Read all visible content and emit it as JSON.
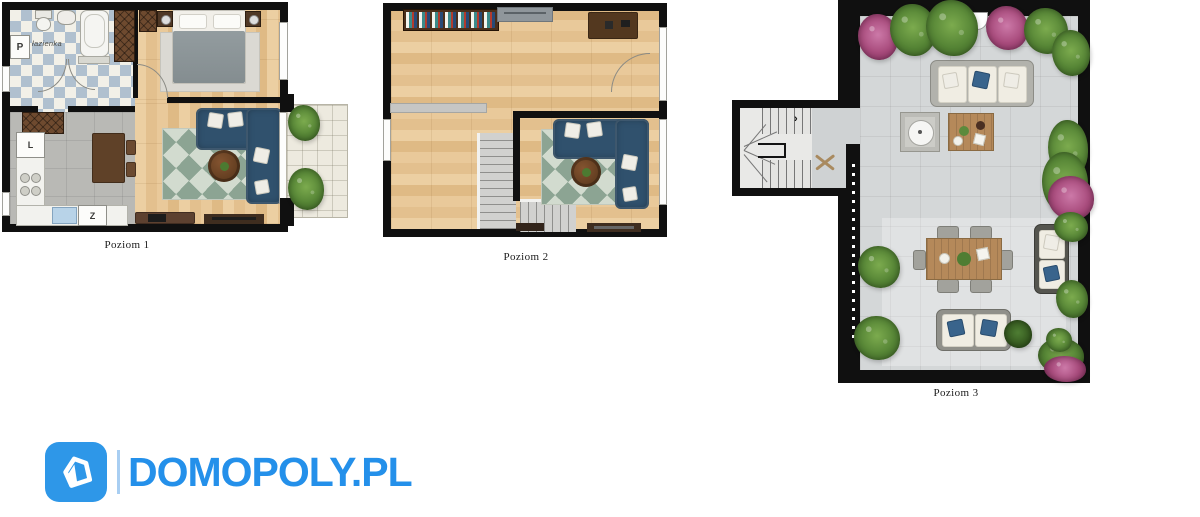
{
  "document": {
    "type": "apartment-floor-plan-sheet",
    "background": "#ffffff"
  },
  "plans": [
    {
      "label": "Poziom 1",
      "labels": {
        "bathroom": "łazienka",
        "pantry": "P",
        "appliance_l": "L",
        "appliance_z": "Z"
      },
      "rooms": [
        "bathroom",
        "hallway",
        "bedroom",
        "kitchen",
        "living-room",
        "balcony"
      ]
    },
    {
      "label": "Poziom 2",
      "rooms": [
        "open-space",
        "living-room",
        "staircase",
        "desk-area"
      ]
    },
    {
      "label": "Poziom 3",
      "annotations": {
        "stairs_arrow": "›"
      },
      "rooms": [
        "roof-terrace",
        "staircase"
      ]
    }
  ],
  "logo": {
    "brand": "DOMOPOLY.PL",
    "icon": "house-icon"
  },
  "colors": {
    "brand_blue": "#2490ea",
    "icon_blue": "#2e97e8",
    "separator_blue": "#a8cef2",
    "wall": "#101010",
    "wood_floor": "#e6c494",
    "kitchen_tile": "#b9b9b5",
    "bath_tile_blue": "#b0c0cf",
    "terrace_tile": "#d4d7d8",
    "balcony_tile": "#edeadf",
    "sofa_navy": "#30516d",
    "rug_green": "#7d9886",
    "plant_green": "#558435",
    "plant_pink": "#a84b7c",
    "outdoor_wood": "#b5895a"
  }
}
